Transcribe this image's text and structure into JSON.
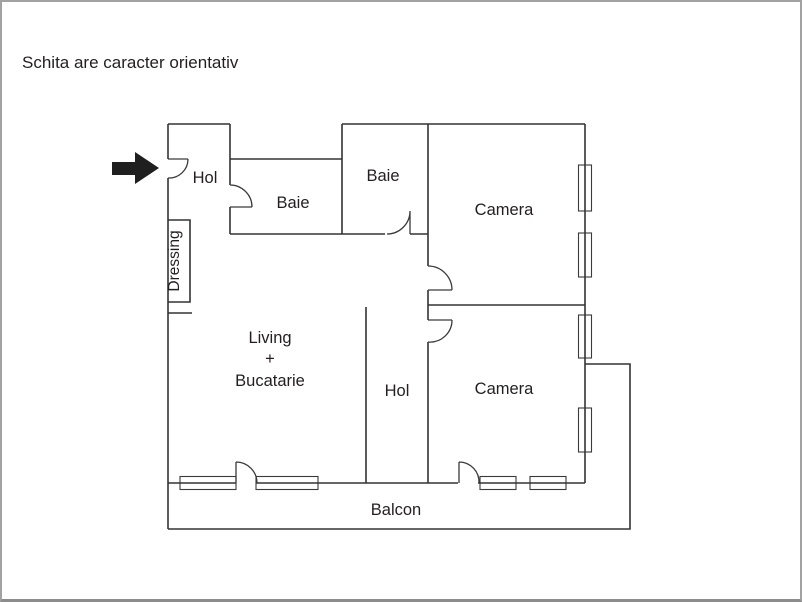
{
  "header": {
    "disclaimer": "Schita are caracter orientativ"
  },
  "floorplan": {
    "rooms": {
      "entry_hall": "Hol",
      "bathroom_1": "Baie",
      "bathroom_2": "Baie",
      "bedroom_1": "Camera",
      "bedroom_2": "Camera",
      "dressing": "Dressing",
      "living_line_1": "Living",
      "living_line_2": "+",
      "living_line_3": "Bucatarie",
      "corridor": "Hol",
      "balcony": "Balcon"
    },
    "icons": {
      "entrance_arrow": "right-arrow",
      "door_symbol": "quarter-arc-door-swing",
      "window_symbol": "double-line-window"
    },
    "colors": {
      "wall": "#333333",
      "text": "#231f20",
      "arrow": "#1f1f1f",
      "frame_border": "#a2a2a2",
      "background": "#ffffff"
    }
  }
}
